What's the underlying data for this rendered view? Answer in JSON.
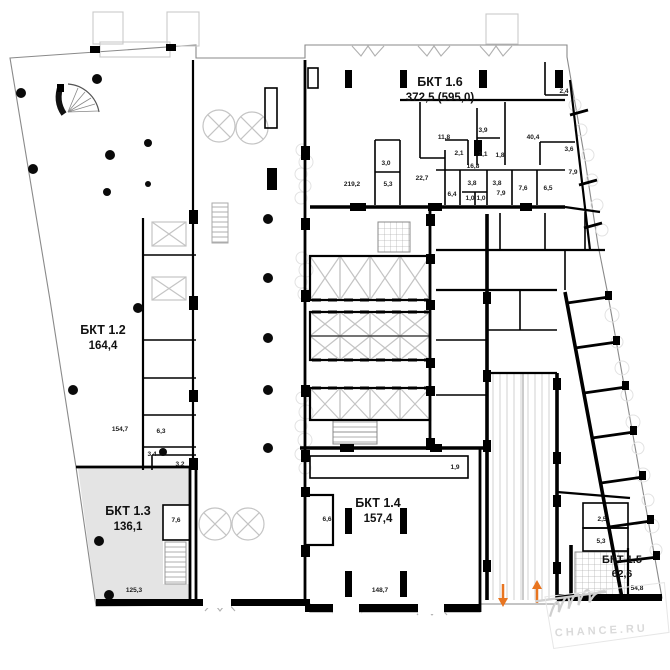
{
  "units": [
    {
      "id": "bkt-1-2",
      "name": "БКТ 1.2",
      "area": "164,4"
    },
    {
      "id": "bkt-1-3",
      "name": "БКТ 1.3",
      "area": "136,1"
    },
    {
      "id": "bkt-1-4",
      "name": "БКТ 1.4",
      "area": "157,4"
    },
    {
      "id": "bkt-1-5",
      "name": "БКТ 1.5",
      "area": "62,6"
    },
    {
      "id": "bkt-1-6",
      "name": "БКТ 1.6",
      "area": "372,5 (595,0)"
    }
  ],
  "room_labels": [
    "219,2",
    "5,3",
    "3,0",
    "22,7",
    "11,8",
    "2,1",
    "3,9",
    "2,1",
    "1,8",
    "16,8",
    "6,4",
    "3,8",
    "3,8",
    "1,0",
    "1,0",
    "7,9",
    "7,6",
    "6,5",
    "7,9",
    "40,4",
    "2,4",
    "3,6",
    "154,7",
    "6,3",
    "3,4",
    "3,2",
    "7,6",
    "125,3",
    "6,6",
    "148,7",
    "1,9",
    "2,5",
    "5,3",
    "54,8"
  ],
  "watermark": {
    "text": "CHANCE.RU"
  },
  "colors": {
    "wall": "#000000",
    "shaded_unit_fill": "#e4e4e4",
    "shaft_lines": "#c4c4c4",
    "entrance_arrow": "#e87520",
    "watermark": "#dadada"
  }
}
